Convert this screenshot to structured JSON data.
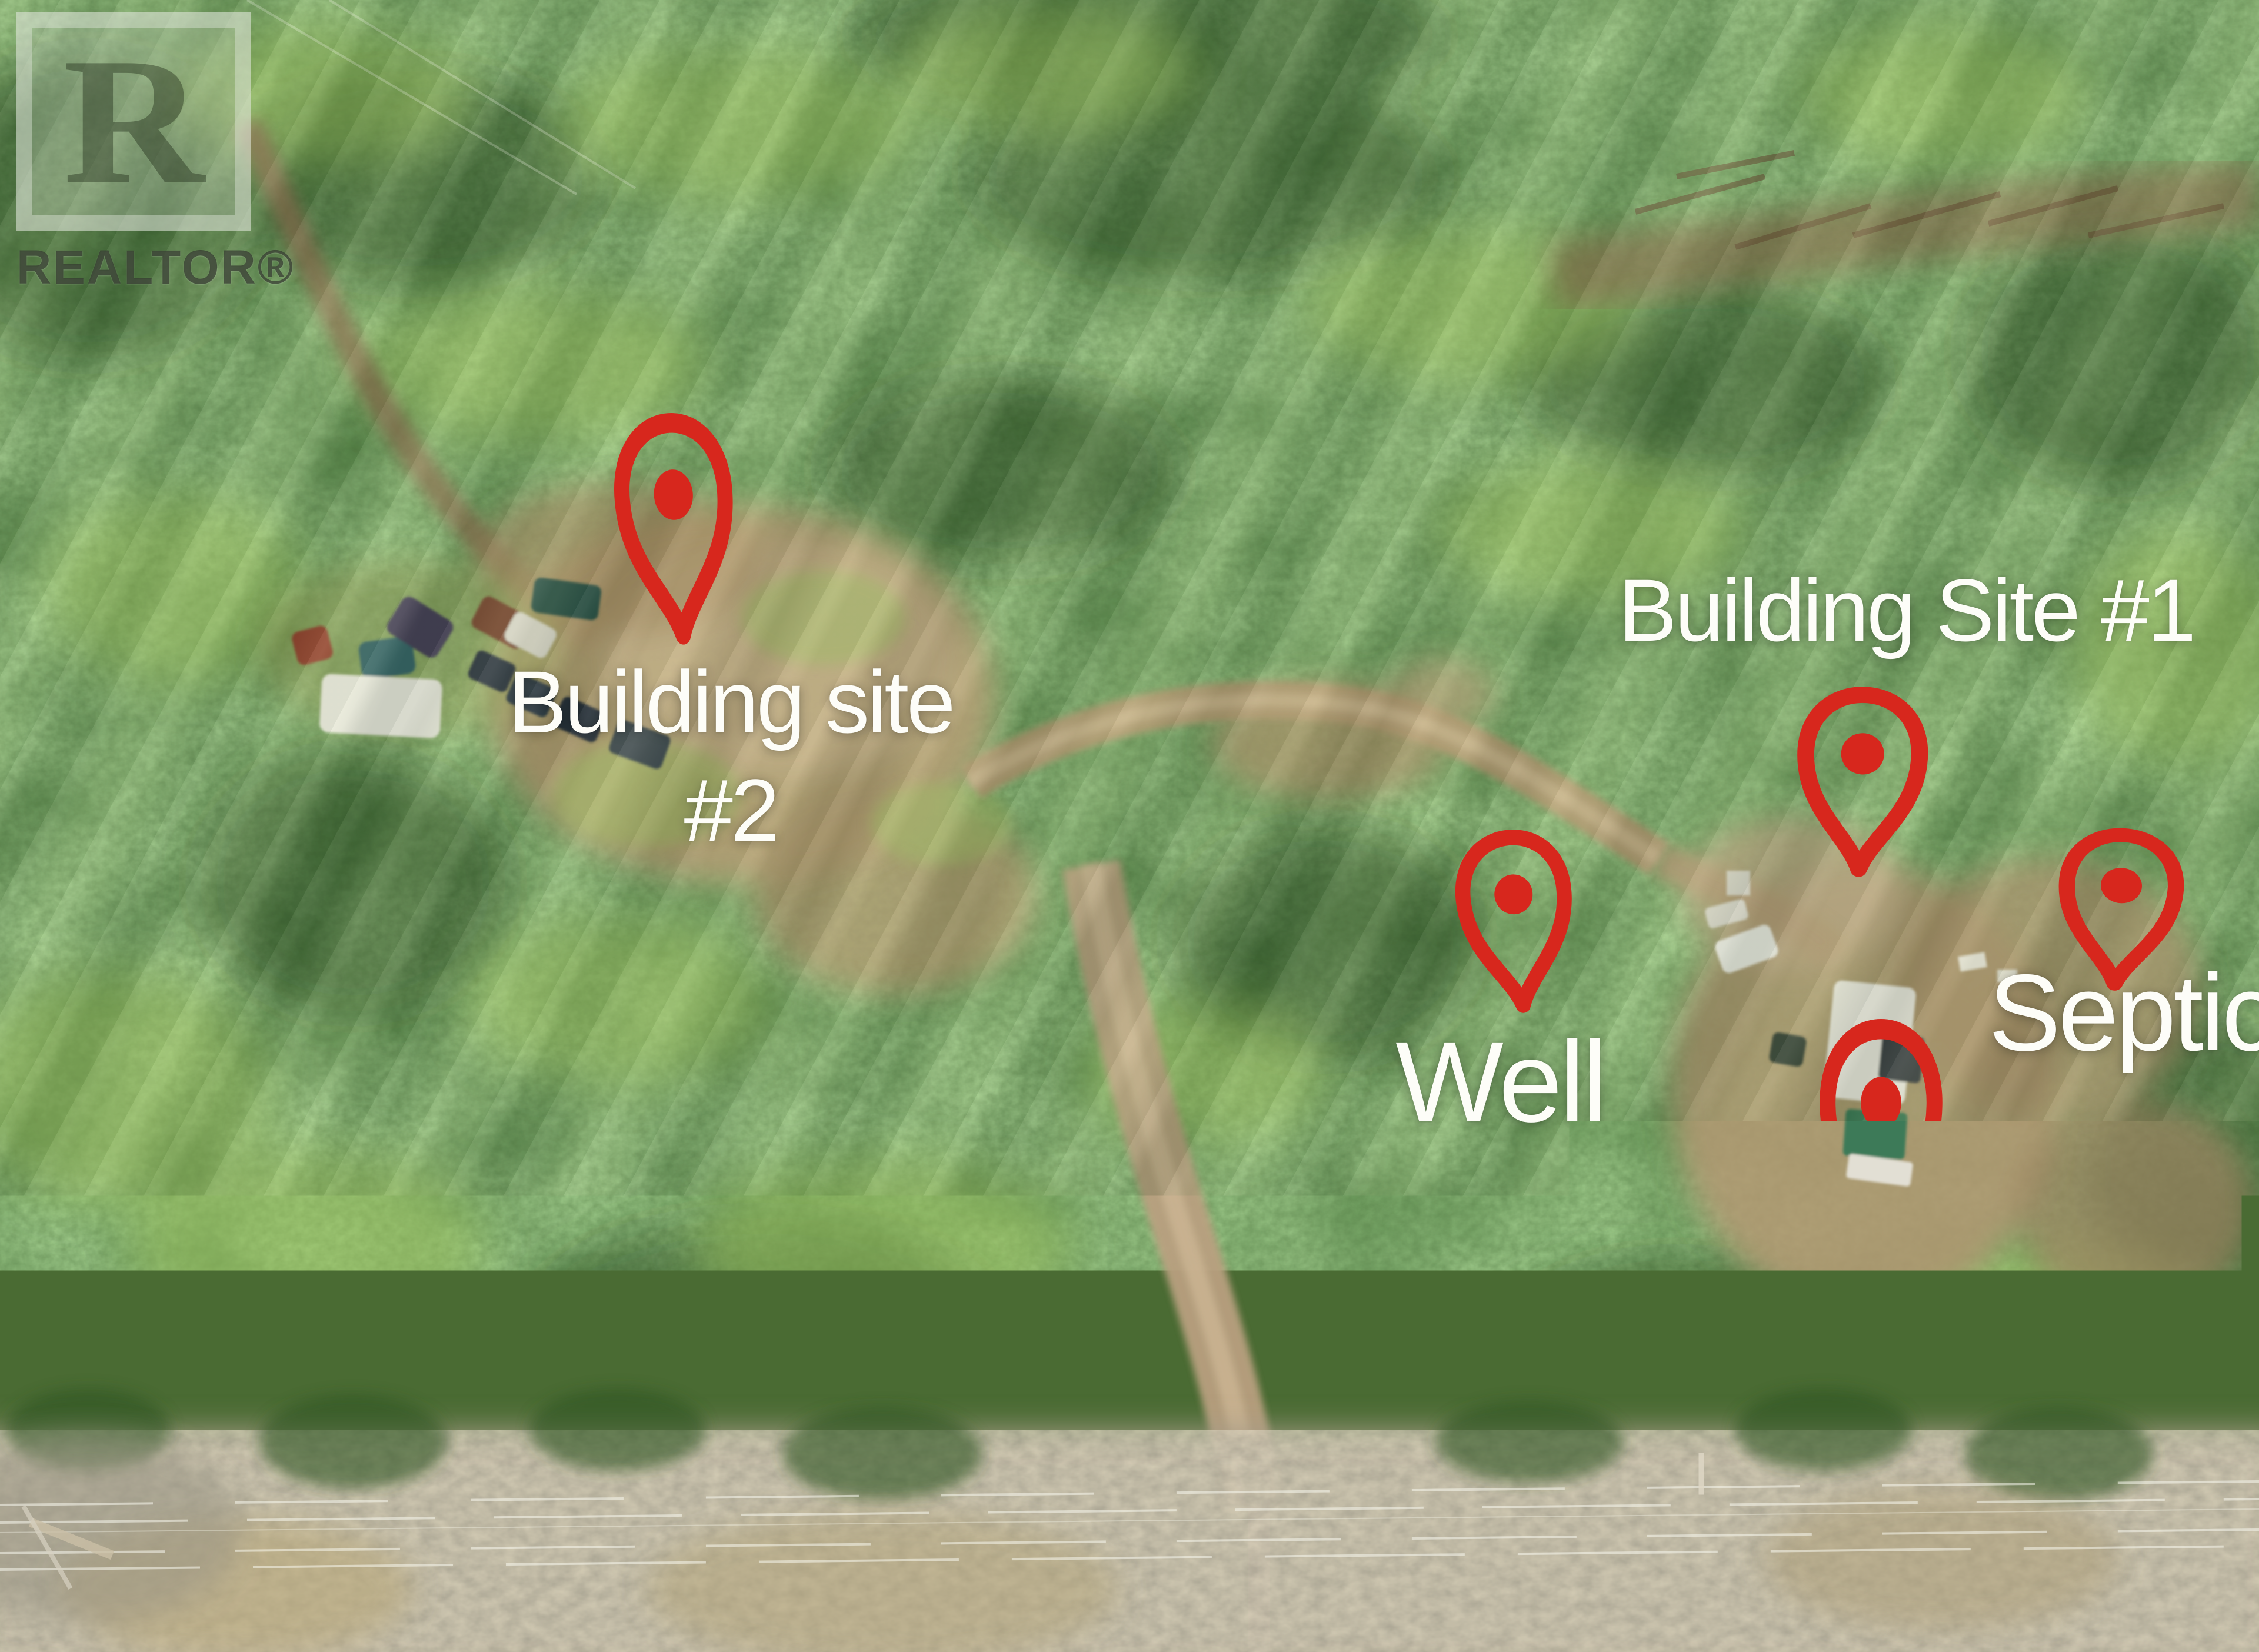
{
  "watermark": {
    "letter": "R",
    "label": "REALTOR®"
  },
  "labels": {
    "building_site_2_line1": "Building site",
    "building_site_2_line2": "#2",
    "building_site_1": "Building Site #1",
    "well": "Well",
    "septic": "Septic",
    "service": "200amp service"
  },
  "pins": [
    {
      "id": "building-site-2",
      "icon": "map-pin-icon"
    },
    {
      "id": "building-site-1",
      "icon": "map-pin-icon"
    },
    {
      "id": "well",
      "icon": "map-pin-icon"
    },
    {
      "id": "septic",
      "icon": "map-pin-icon"
    },
    {
      "id": "200amp-service",
      "icon": "map-pin-icon"
    }
  ],
  "colors": {
    "pin_red": "#d7271d",
    "label_text": "#fdfdf8",
    "forest_green_dark": "#2c4c1c",
    "forest_green_light": "#8fb957",
    "clearing_tan": "#b79b74",
    "scrub_gray": "#a59c88"
  }
}
